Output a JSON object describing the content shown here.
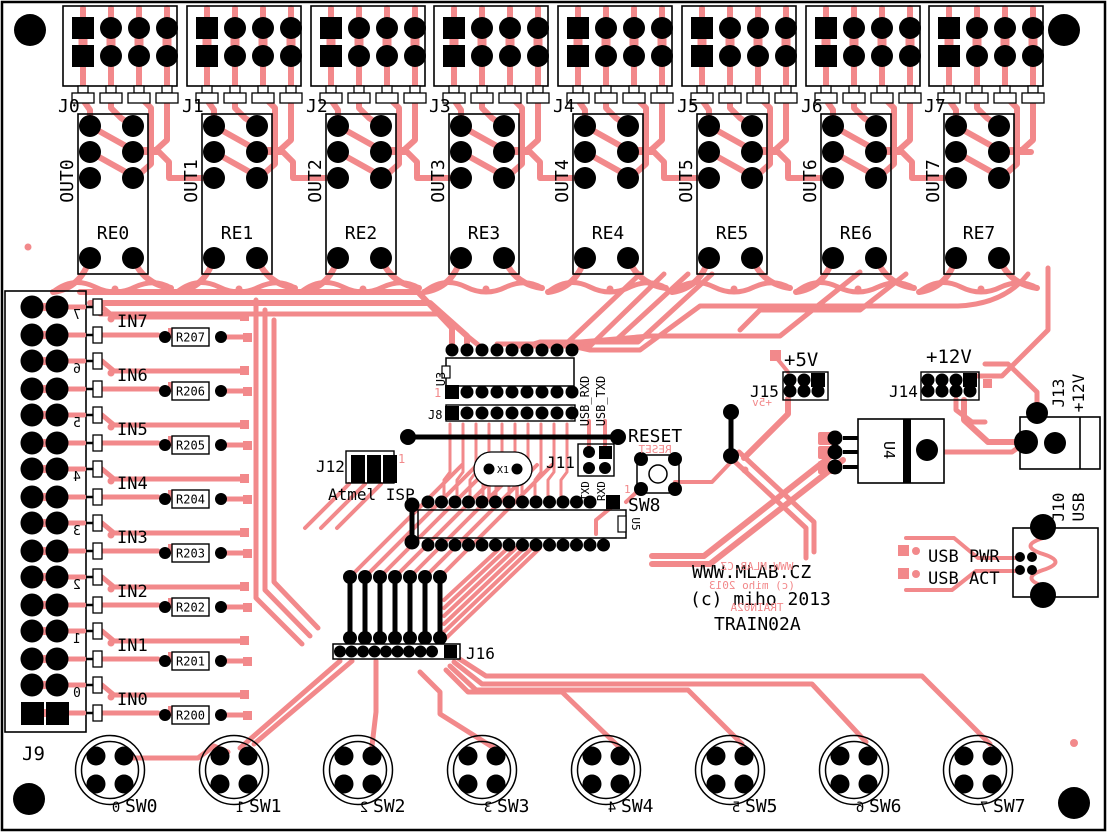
{
  "silkscreen": {
    "website": "WWW.MLAB.CZ",
    "copyright": "(c) miho 2013",
    "board_name": "TRAIN02A",
    "website_mirror": "WWW.MLAB.CZ",
    "copyright_mirror": "(c) miho 2013",
    "board_name_mirror": "TRAIN02A"
  },
  "relay_blocks": [
    {
      "connector": "J0",
      "output": "OUT0",
      "relay": "RE0"
    },
    {
      "connector": "J1",
      "output": "OUT1",
      "relay": "RE1"
    },
    {
      "connector": "J2",
      "output": "OUT2",
      "relay": "RE2"
    },
    {
      "connector": "J3",
      "output": "OUT3",
      "relay": "RE3"
    },
    {
      "connector": "J4",
      "output": "OUT4",
      "relay": "RE4"
    },
    {
      "connector": "J5",
      "output": "OUT5",
      "relay": "RE5"
    },
    {
      "connector": "J6",
      "output": "OUT6",
      "relay": "RE6"
    },
    {
      "connector": "J7",
      "output": "OUT7",
      "relay": "RE7"
    }
  ],
  "inputs": [
    {
      "label": "IN7",
      "resistor": "R207",
      "digit": "7"
    },
    {
      "label": "IN6",
      "resistor": "R206",
      "digit": "6"
    },
    {
      "label": "IN5",
      "resistor": "R205",
      "digit": "5"
    },
    {
      "label": "IN4",
      "resistor": "R204",
      "digit": "4"
    },
    {
      "label": "IN3",
      "resistor": "R203",
      "digit": "3"
    },
    {
      "label": "IN2",
      "resistor": "R202",
      "digit": "2"
    },
    {
      "label": "IN1",
      "resistor": "R201",
      "digit": "1"
    },
    {
      "label": "IN0",
      "resistor": "R200",
      "digit": "0"
    }
  ],
  "input_connector": "J9",
  "switches": [
    {
      "label": "SW0",
      "digit": "0"
    },
    {
      "label": "SW1",
      "digit": "1"
    },
    {
      "label": "SW2",
      "digit": "2"
    },
    {
      "label": "SW3",
      "digit": "3"
    },
    {
      "label": "SW4",
      "digit": "4"
    },
    {
      "label": "SW5",
      "digit": "5"
    },
    {
      "label": "SW6",
      "digit": "6"
    },
    {
      "label": "SW7",
      "digit": "7"
    }
  ],
  "center": {
    "u3": "U3",
    "pin1": "1",
    "j8": "J8",
    "usb_rxd": "USB_RXD",
    "usb_txd": "USB_TXD",
    "j11": "J11",
    "txd": "TXD",
    "rxd": "RXD",
    "crystal": "X1",
    "j12": "J12",
    "isp_caption": "Atmel ISP",
    "isp_pin1": "1",
    "reset": "RESET",
    "reset_mirror": "RESET",
    "reset_pin1": "1",
    "sw8": "SW8",
    "mcu": "U5",
    "j16": "J16"
  },
  "power": {
    "plus5": "+5V",
    "plus5_mirror": "+5v",
    "j15": "J15",
    "plus12": "+12V",
    "j14": "J14",
    "regulator": "U4",
    "j13": "J13",
    "j13_voltage": "+12V"
  },
  "usb": {
    "j10": "J10",
    "usb": "USB",
    "pwr": "USB PWR",
    "act": "USB ACT"
  },
  "colors": {
    "copper": "#F2898B",
    "silkscreen": "#000000",
    "board": "#FFFFFF",
    "drill": "#000000"
  }
}
